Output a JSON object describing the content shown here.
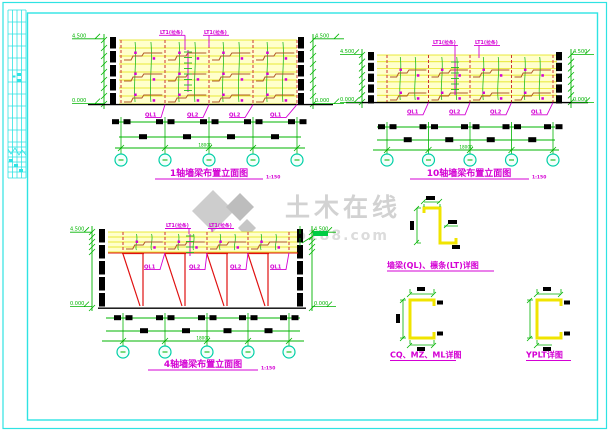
{
  "watermark": {
    "brand": "土木在线",
    "domain": "co188.com"
  },
  "elevations": [
    {
      "title": "1轴墙梁布置立面图",
      "scale": "1:150",
      "elev_top": "4.500",
      "elev_bottom": "0.000",
      "span": "18000",
      "ties": [
        "LT1(拉条)",
        "LT1(拉条)"
      ],
      "beams": [
        "QL1",
        "QL2",
        "QL2",
        "QL1"
      ]
    },
    {
      "title": "10轴墙梁布置立面图",
      "scale": "1:150",
      "elev_top": "4.500",
      "elev_bottom": "0.000",
      "span": "18000",
      "ties": [
        "LT1(拉条)",
        "LT1(拉条)"
      ],
      "beams": [
        "QL1",
        "QL2",
        "QL2",
        "QL1"
      ]
    },
    {
      "title": "4轴墙梁布置立面图",
      "scale": "1:150",
      "elev_top": "4.500",
      "elev_bottom": "0.000",
      "span": "18000",
      "ties": [
        "LT1(拉条)",
        "LT1(拉条)"
      ],
      "beams": [
        "QL1",
        "QL2",
        "QL2",
        "QL1"
      ]
    }
  ],
  "details": {
    "girt_purlin_title": "墙梁(QL)、檩条(LT)详图",
    "cq_mz_ml_title": "CQ、MZ、ML详图",
    "yplt_title": "YPLT详图"
  },
  "colors": {
    "frame": "#2ee3e3",
    "green": "#00b400",
    "magenta": "#d400d4",
    "red": "#cc3333",
    "band_fill": "#ffffcc",
    "profile_yellow": "#f0e400",
    "brown": "#b05828",
    "watermark": "#d2d2d2"
  }
}
